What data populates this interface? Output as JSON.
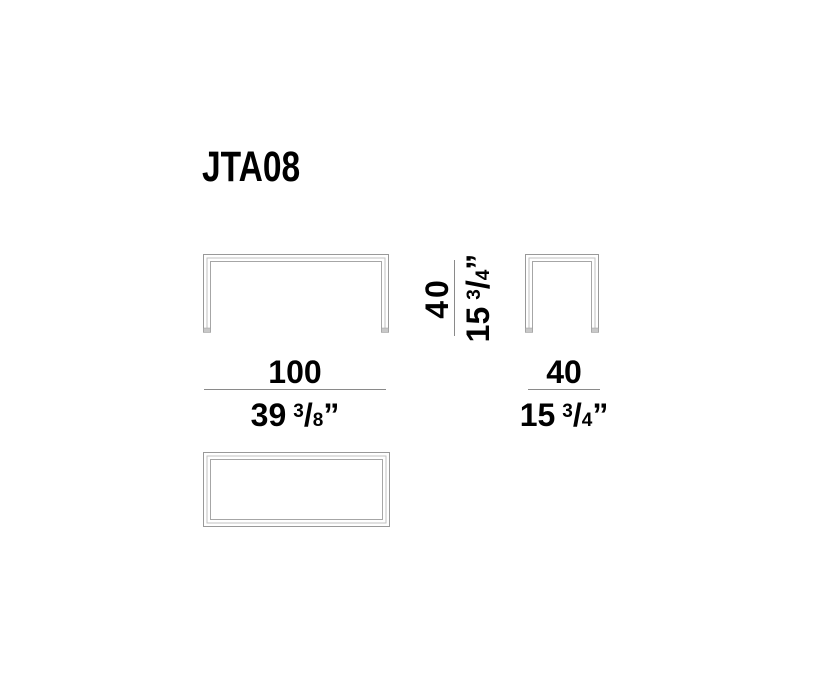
{
  "title": "JTA08",
  "drawing": {
    "line_color_outer": "#999999",
    "line_color_mid": "#c2c2c2",
    "line_color_inner": "#a6a6a6",
    "foot_color": "#c8c8c8",
    "dimension_rule_color": "#8a8a8a"
  },
  "dimensions": {
    "width": {
      "cm": "100",
      "inch_whole": "39",
      "inch_num": "3",
      "slash": "/",
      "inch_den": "8",
      "unit_mark": "”"
    },
    "depth": {
      "cm": "40",
      "inch_whole": "15",
      "inch_num": "3",
      "slash": "/",
      "inch_den": "4",
      "unit_mark": "”"
    },
    "height": {
      "cm": "40",
      "inch_whole": "15",
      "inch_num": "3",
      "slash": "/",
      "inch_den": "4",
      "unit_mark": "”"
    }
  }
}
